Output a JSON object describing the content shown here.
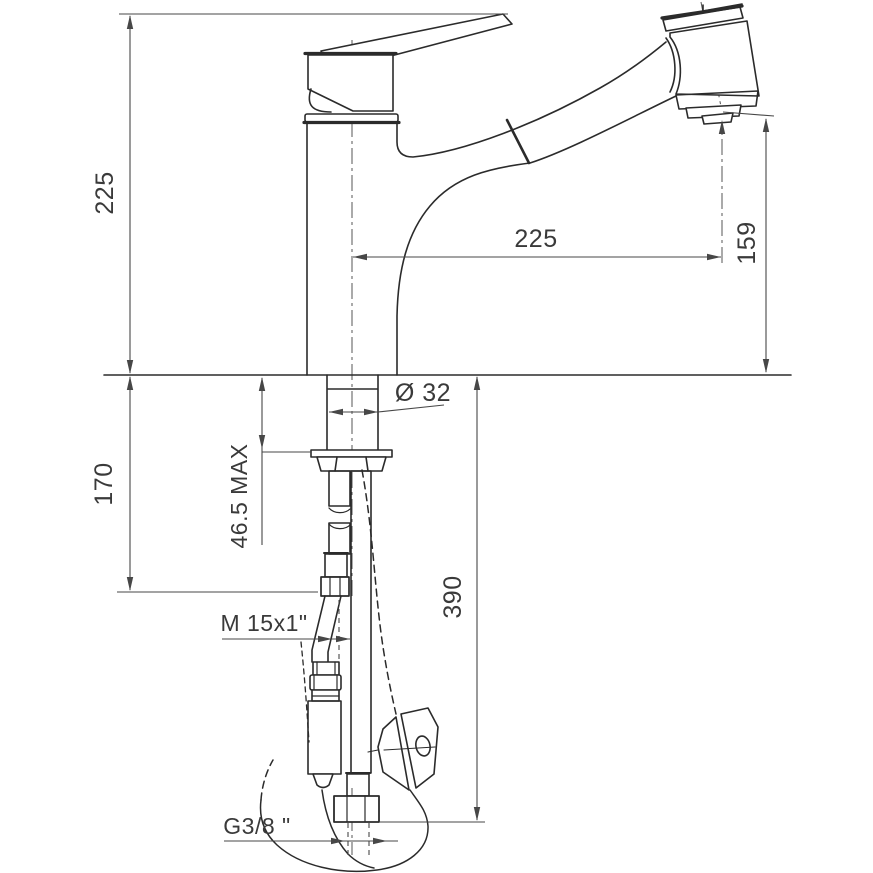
{
  "drawing": {
    "kind": "faucet-technical-drawing",
    "labels": {
      "height_above_deck": "225",
      "spout_reach": "225",
      "outlet_height": "159",
      "shank_diameter": "Ø 32",
      "mounting_depth_max": "46.5 MAX",
      "clearance_below_deck": "170",
      "hose_drop_length": "390",
      "supply_thread": "M 15x1\"",
      "connection_thread": "G3/8 \""
    },
    "colors": {
      "line": "#2b2b2b",
      "dimension": "#474747",
      "text": "#3a3a3a",
      "background": "#ffffff"
    }
  }
}
